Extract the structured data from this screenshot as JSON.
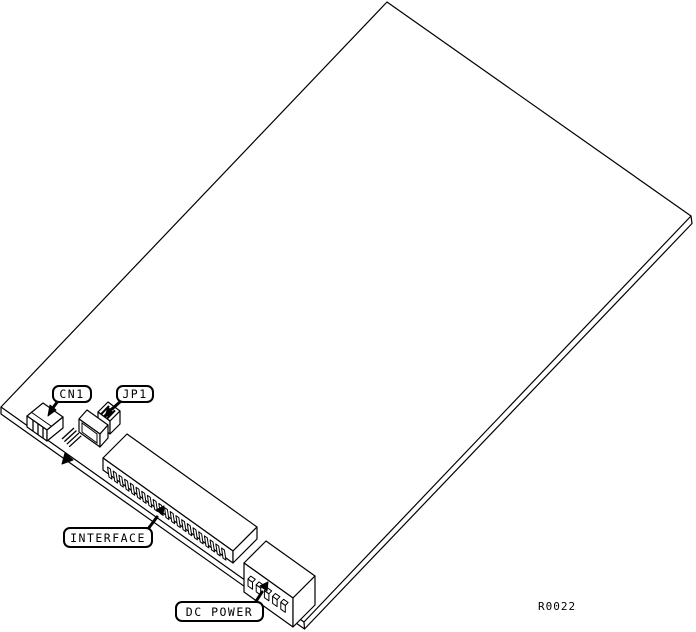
{
  "figure": {
    "type": "isometric-line-diagram",
    "drawing_number": "R0022",
    "callouts": [
      {
        "id": "cn1",
        "label": "CN1"
      },
      {
        "id": "jp1",
        "label": "JP1"
      },
      {
        "id": "interface",
        "label": "INTERFACE"
      },
      {
        "id": "dc_power",
        "label": "DC POWER"
      }
    ],
    "colors": {
      "line": "#000000",
      "background": "#ffffff"
    },
    "interface_pin_count": 21,
    "dc_power_pin_count": 5,
    "jp1_wire_count": 4,
    "cn1_tooth_count": 3,
    "jp1_hatch_count": 3
  }
}
